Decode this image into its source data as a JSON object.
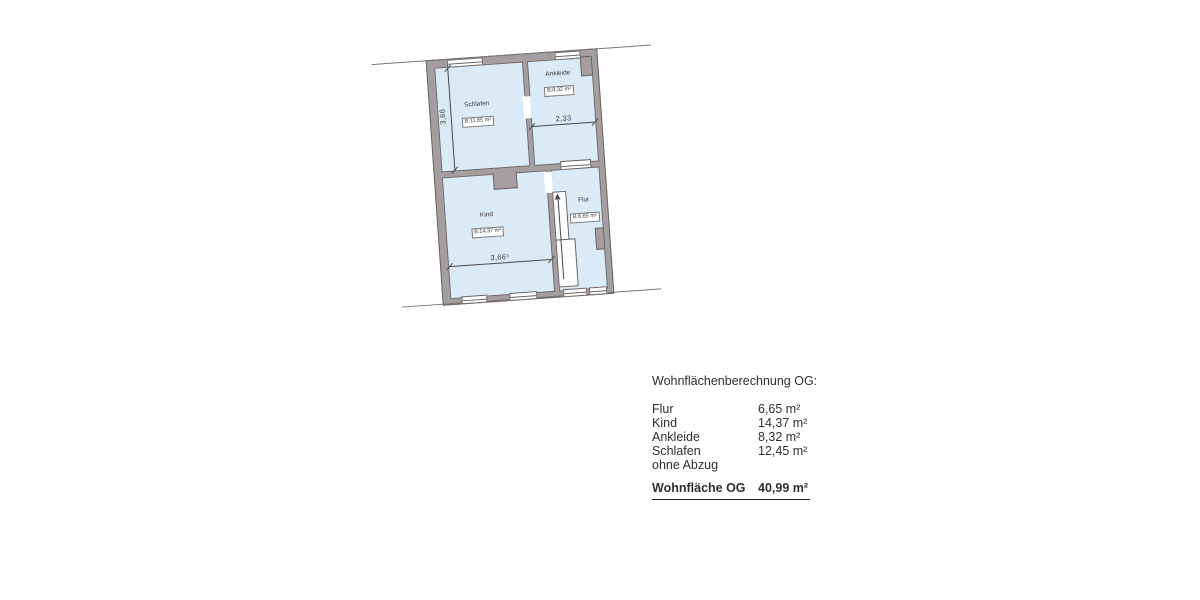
{
  "floor_plan": {
    "rooms": [
      {
        "name": "Schlafen",
        "area_label": "B:11,65 m²"
      },
      {
        "name": "Ankleide",
        "area_label": "B:8,32 m²"
      },
      {
        "name": "Kind",
        "area_label": "B:14,37 m²"
      },
      {
        "name": "Flur",
        "area_label": "B:6,65 m²"
      }
    ],
    "dimensions": {
      "schlafen_height": "3,66",
      "ankleide_width": "2,33",
      "kind_width": "3,66⁵"
    },
    "colors": {
      "wall": "#a59e9e",
      "room_fill": "#dbeaf7",
      "edge_line": "#6b6564"
    }
  },
  "calculation": {
    "title": "Wohnflächenberechnung OG:",
    "rows": [
      {
        "label": "Flur",
        "value": "6,65 m²"
      },
      {
        "label": "Kind",
        "value": "14,37 m²"
      },
      {
        "label": "Ankleide",
        "value": "8,32 m²"
      },
      {
        "label": "Schlafen",
        "value": "12,45 m²"
      },
      {
        "label": "ohne Abzug",
        "value": ""
      }
    ],
    "total": {
      "label": "Wohnfläche OG",
      "value": "40,99 m²"
    }
  }
}
